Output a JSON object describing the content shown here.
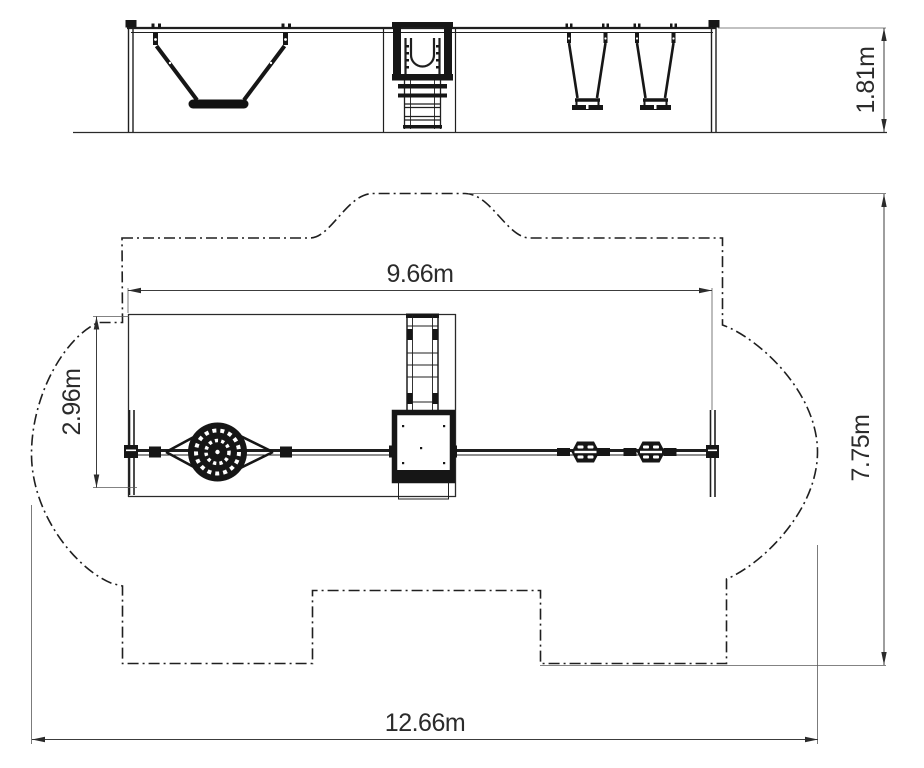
{
  "drawing": {
    "type": "playground-equipment-technical-drawing",
    "colors": {
      "background": "#ffffff",
      "main_line": "#1f1f1f",
      "dim_line": "#3c3c3c",
      "extension_line": "#5a5a5a"
    },
    "dimensions": {
      "overall_height": "1.81m",
      "frame_span": "9.66m",
      "frame_depth": "2.96m",
      "safety_zone_depth": "7.75m",
      "safety_zone_width": "12.66m"
    }
  }
}
